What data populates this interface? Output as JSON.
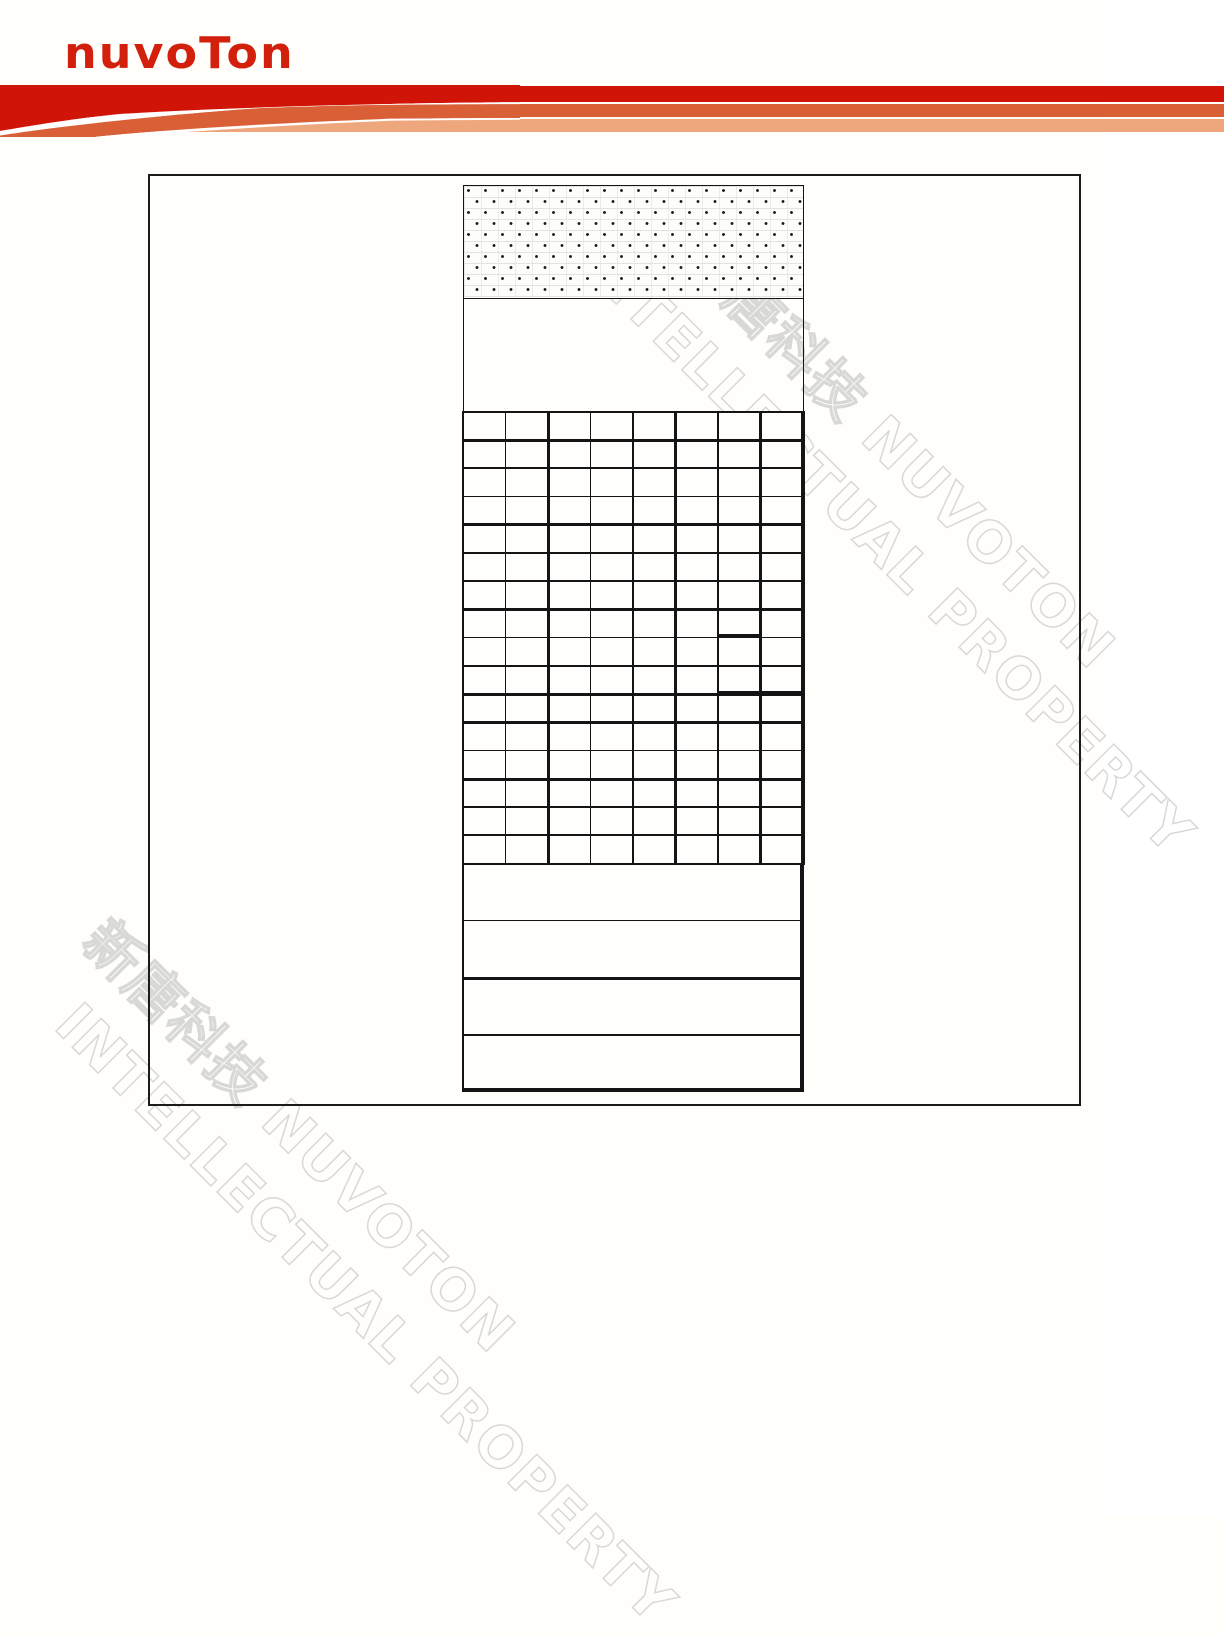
{
  "page": {
    "background": "#fffefa"
  },
  "logo": {
    "text": "nuvoTon",
    "color": "#d2200d"
  },
  "header": {
    "band_colors": [
      "#d01508",
      "#d96036",
      "#eea67c"
    ],
    "gap_color": "#ffffff"
  },
  "watermarks": {
    "rotation_deg": 45,
    "stroke_color": "#d8d8d6",
    "groups": [
      {
        "id": "top-right",
        "lines": [
          {
            "text": "新唐科技 NUVOTON",
            "x": 712,
            "y": 228
          },
          {
            "text": "INTELLECTUAL PROPERTY",
            "x": 603,
            "y": 226
          }
        ]
      },
      {
        "id": "bottom-left",
        "lines": [
          {
            "text": "新唐科技 NUVOTON",
            "x": 112,
            "y": 912
          },
          {
            "text": "INTELLECTUAL PROPERTY",
            "x": 85,
            "y": 995
          }
        ]
      }
    ]
  },
  "diagram": {
    "outer_frame": {
      "x": 148,
      "y": 174,
      "w": 929,
      "h": 928
    },
    "dotted_box": {
      "x": 462.5,
      "y": 184.5,
      "w": 341,
      "h": 114
    },
    "empty_box": {
      "x": 462.5,
      "y": 298,
      "w": 341,
      "h": 114
    },
    "grid_area": {
      "x": 462,
      "y": 411,
      "w": 342.5,
      "h": 454,
      "cols": 8,
      "rows": 16
    },
    "tall_area": {
      "x": 462,
      "y": 864,
      "w": 342.5,
      "h": 228,
      "rows": 4
    },
    "line_color": "#141414",
    "lines": [
      {
        "x": 462,
        "y": 411,
        "w": 2,
        "h": 454
      },
      {
        "x": 504.7,
        "y": 411,
        "w": 1.5,
        "h": 454
      },
      {
        "x": 546.5,
        "y": 411,
        "w": 3,
        "h": 454
      },
      {
        "x": 589.7,
        "y": 411,
        "w": 1.5,
        "h": 454
      },
      {
        "x": 632.2,
        "y": 411,
        "w": 1.5,
        "h": 454
      },
      {
        "x": 674,
        "y": 411,
        "w": 3,
        "h": 454
      },
      {
        "x": 717,
        "y": 411,
        "w": 2,
        "h": 454
      },
      {
        "x": 759.2,
        "y": 411,
        "w": 2.5,
        "h": 454
      },
      {
        "x": 801,
        "y": 411,
        "w": 3.5,
        "h": 454
      },
      {
        "x": 462,
        "y": 410.5,
        "w": 342.5,
        "h": 2.5
      },
      {
        "x": 462,
        "y": 438.5,
        "w": 342.5,
        "h": 3
      },
      {
        "x": 462,
        "y": 467.2,
        "w": 342.5,
        "h": 1.5
      },
      {
        "x": 462,
        "y": 495.7,
        "w": 342.5,
        "h": 1.5
      },
      {
        "x": 462,
        "y": 523,
        "w": 342.5,
        "h": 3
      },
      {
        "x": 462,
        "y": 552.2,
        "w": 342.5,
        "h": 1.5
      },
      {
        "x": 462,
        "y": 580.2,
        "w": 342.5,
        "h": 1.5
      },
      {
        "x": 462,
        "y": 607.5,
        "w": 342.5,
        "h": 3
      },
      {
        "x": 462,
        "y": 636.7,
        "w": 342.5,
        "h": 1.5
      },
      {
        "x": 462,
        "y": 665.2,
        "w": 342.5,
        "h": 1.5
      },
      {
        "x": 462,
        "y": 692.5,
        "w": 342.5,
        "h": 3
      },
      {
        "x": 462,
        "y": 720.5,
        "w": 342.5,
        "h": 3
      },
      {
        "x": 462,
        "y": 749.7,
        "w": 342.5,
        "h": 1.5
      },
      {
        "x": 462,
        "y": 777.5,
        "w": 342.5,
        "h": 3
      },
      {
        "x": 462,
        "y": 806.2,
        "w": 342.5,
        "h": 1.5
      },
      {
        "x": 462,
        "y": 834.2,
        "w": 342.5,
        "h": 1.5
      },
      {
        "x": 462,
        "y": 862.5,
        "w": 342.5,
        "h": 2.5
      },
      {
        "x": 717,
        "y": 633.5,
        "w": 44,
        "h": 4
      },
      {
        "x": 717,
        "y": 691,
        "w": 87,
        "h": 5
      },
      {
        "x": 462,
        "y": 864,
        "w": 1.5,
        "h": 227
      },
      {
        "x": 799.5,
        "y": 864,
        "w": 4,
        "h": 227.5
      },
      {
        "x": 462,
        "y": 919.5,
        "w": 341.5,
        "h": 1.5
      },
      {
        "x": 462,
        "y": 976.5,
        "w": 341.5,
        "h": 3
      },
      {
        "x": 462,
        "y": 1033.5,
        "w": 341.5,
        "h": 2
      },
      {
        "x": 462,
        "y": 1087.5,
        "w": 341.5,
        "h": 4
      }
    ]
  }
}
